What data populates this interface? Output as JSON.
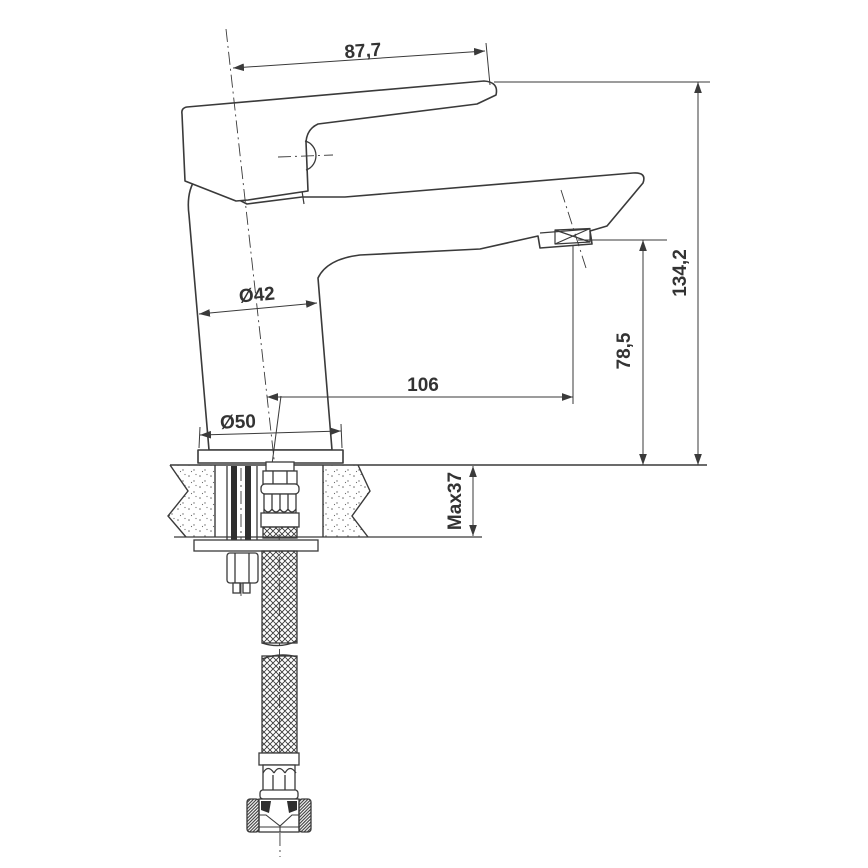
{
  "drawing": {
    "type": "technical-dimension-drawing",
    "subject": "single-lever basin mixer tap, side view with deck mounting cross-section and flexible supply hose",
    "colors": {
      "line": "#3a3a3a",
      "text": "#333333",
      "background": "#ffffff"
    },
    "dimensions": {
      "lever_length": "87,7",
      "total_height": "134,2",
      "outlet_height": "78,5",
      "spout_reach": "106",
      "body_diameter": "Ø42",
      "base_diameter": "Ø50",
      "max_deck_thickness": "Max37"
    }
  }
}
